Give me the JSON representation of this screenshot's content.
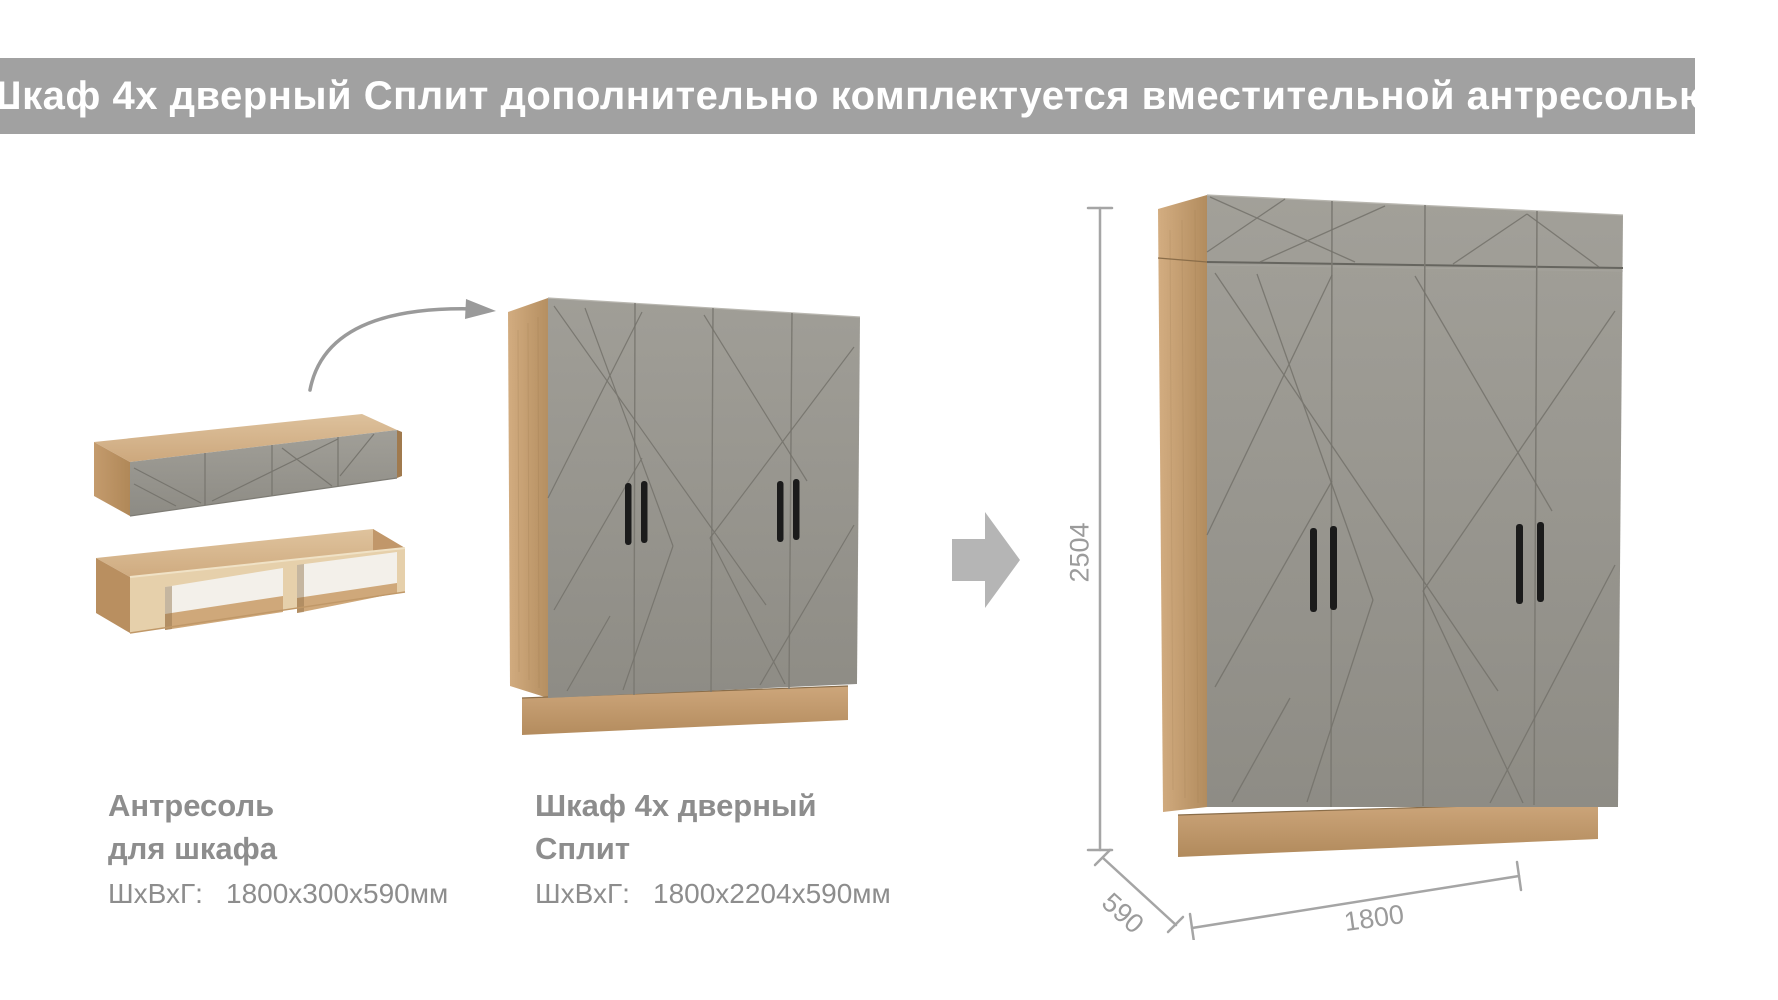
{
  "banner": {
    "text": "Шкаф 4х дверный Сплит дополнительно комплектуется вместительной антресолью",
    "background": "#a1a1a1",
    "color": "#ffffff"
  },
  "products": [
    {
      "name": "Антресоль для шкафа",
      "title_line1": "Антресоль",
      "title_line2": "для шкафа",
      "dims_label": "ШхВхГ:",
      "dims_value": "1800х300х590мм"
    },
    {
      "name": "Шкаф 4х дверный Сплит",
      "title_line1": "Шкаф 4х дверный",
      "title_line2": "Сплит",
      "dims_label": "ШхВхГ:",
      "dims_value": "1800х2204х590мм"
    }
  ],
  "dimensions": {
    "height_mm": "2504",
    "depth_mm": "590",
    "width_mm": "1800"
  },
  "icons": {
    "curved_arrow": "curved-arrow-icon",
    "right_arrow": "right-arrow-icon"
  },
  "colors": {
    "door_gray": "#99978f",
    "wood": "#c9a173",
    "wood_light": "#dcc09a",
    "label_text_gray": "#8d8d8d",
    "dimension_gray": "#9b9b9b",
    "arrow_gray": "#b5b5b5",
    "handle_black": "#1b1b1b",
    "interior_white": "#f3f0ea"
  }
}
